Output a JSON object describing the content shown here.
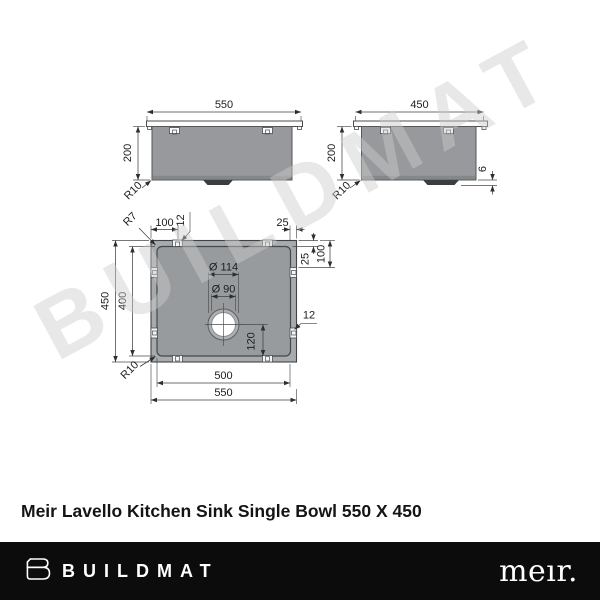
{
  "watermark": "BUILDMAT",
  "product_title": "Meir Lavello Kitchen Sink Single Bowl 550 X 450",
  "footer": {
    "brand": "BUILDMAT",
    "partner_brand": "meır."
  },
  "front_view": {
    "width": "550",
    "depth": "200",
    "radius": "R10"
  },
  "side_view": {
    "width": "450",
    "depth": "200",
    "radius": "R10",
    "drain_height": "6"
  },
  "top_view": {
    "outer_width": "550",
    "inner_width": "500",
    "outer_height": "450",
    "inner_height": "400",
    "clip_offset_top": "100",
    "clip_slot_top": "12",
    "flange_width_top": "25",
    "flange_width_right": "25",
    "clip_offset_right": "100",
    "clip_slot_right": "12",
    "drain_outer_dia": "Ø 114",
    "drain_hole_dia": "Ø 90",
    "drain_center_from_back": "120",
    "corner_radius_top": "R7",
    "corner_radius_bowl": "R10"
  }
}
